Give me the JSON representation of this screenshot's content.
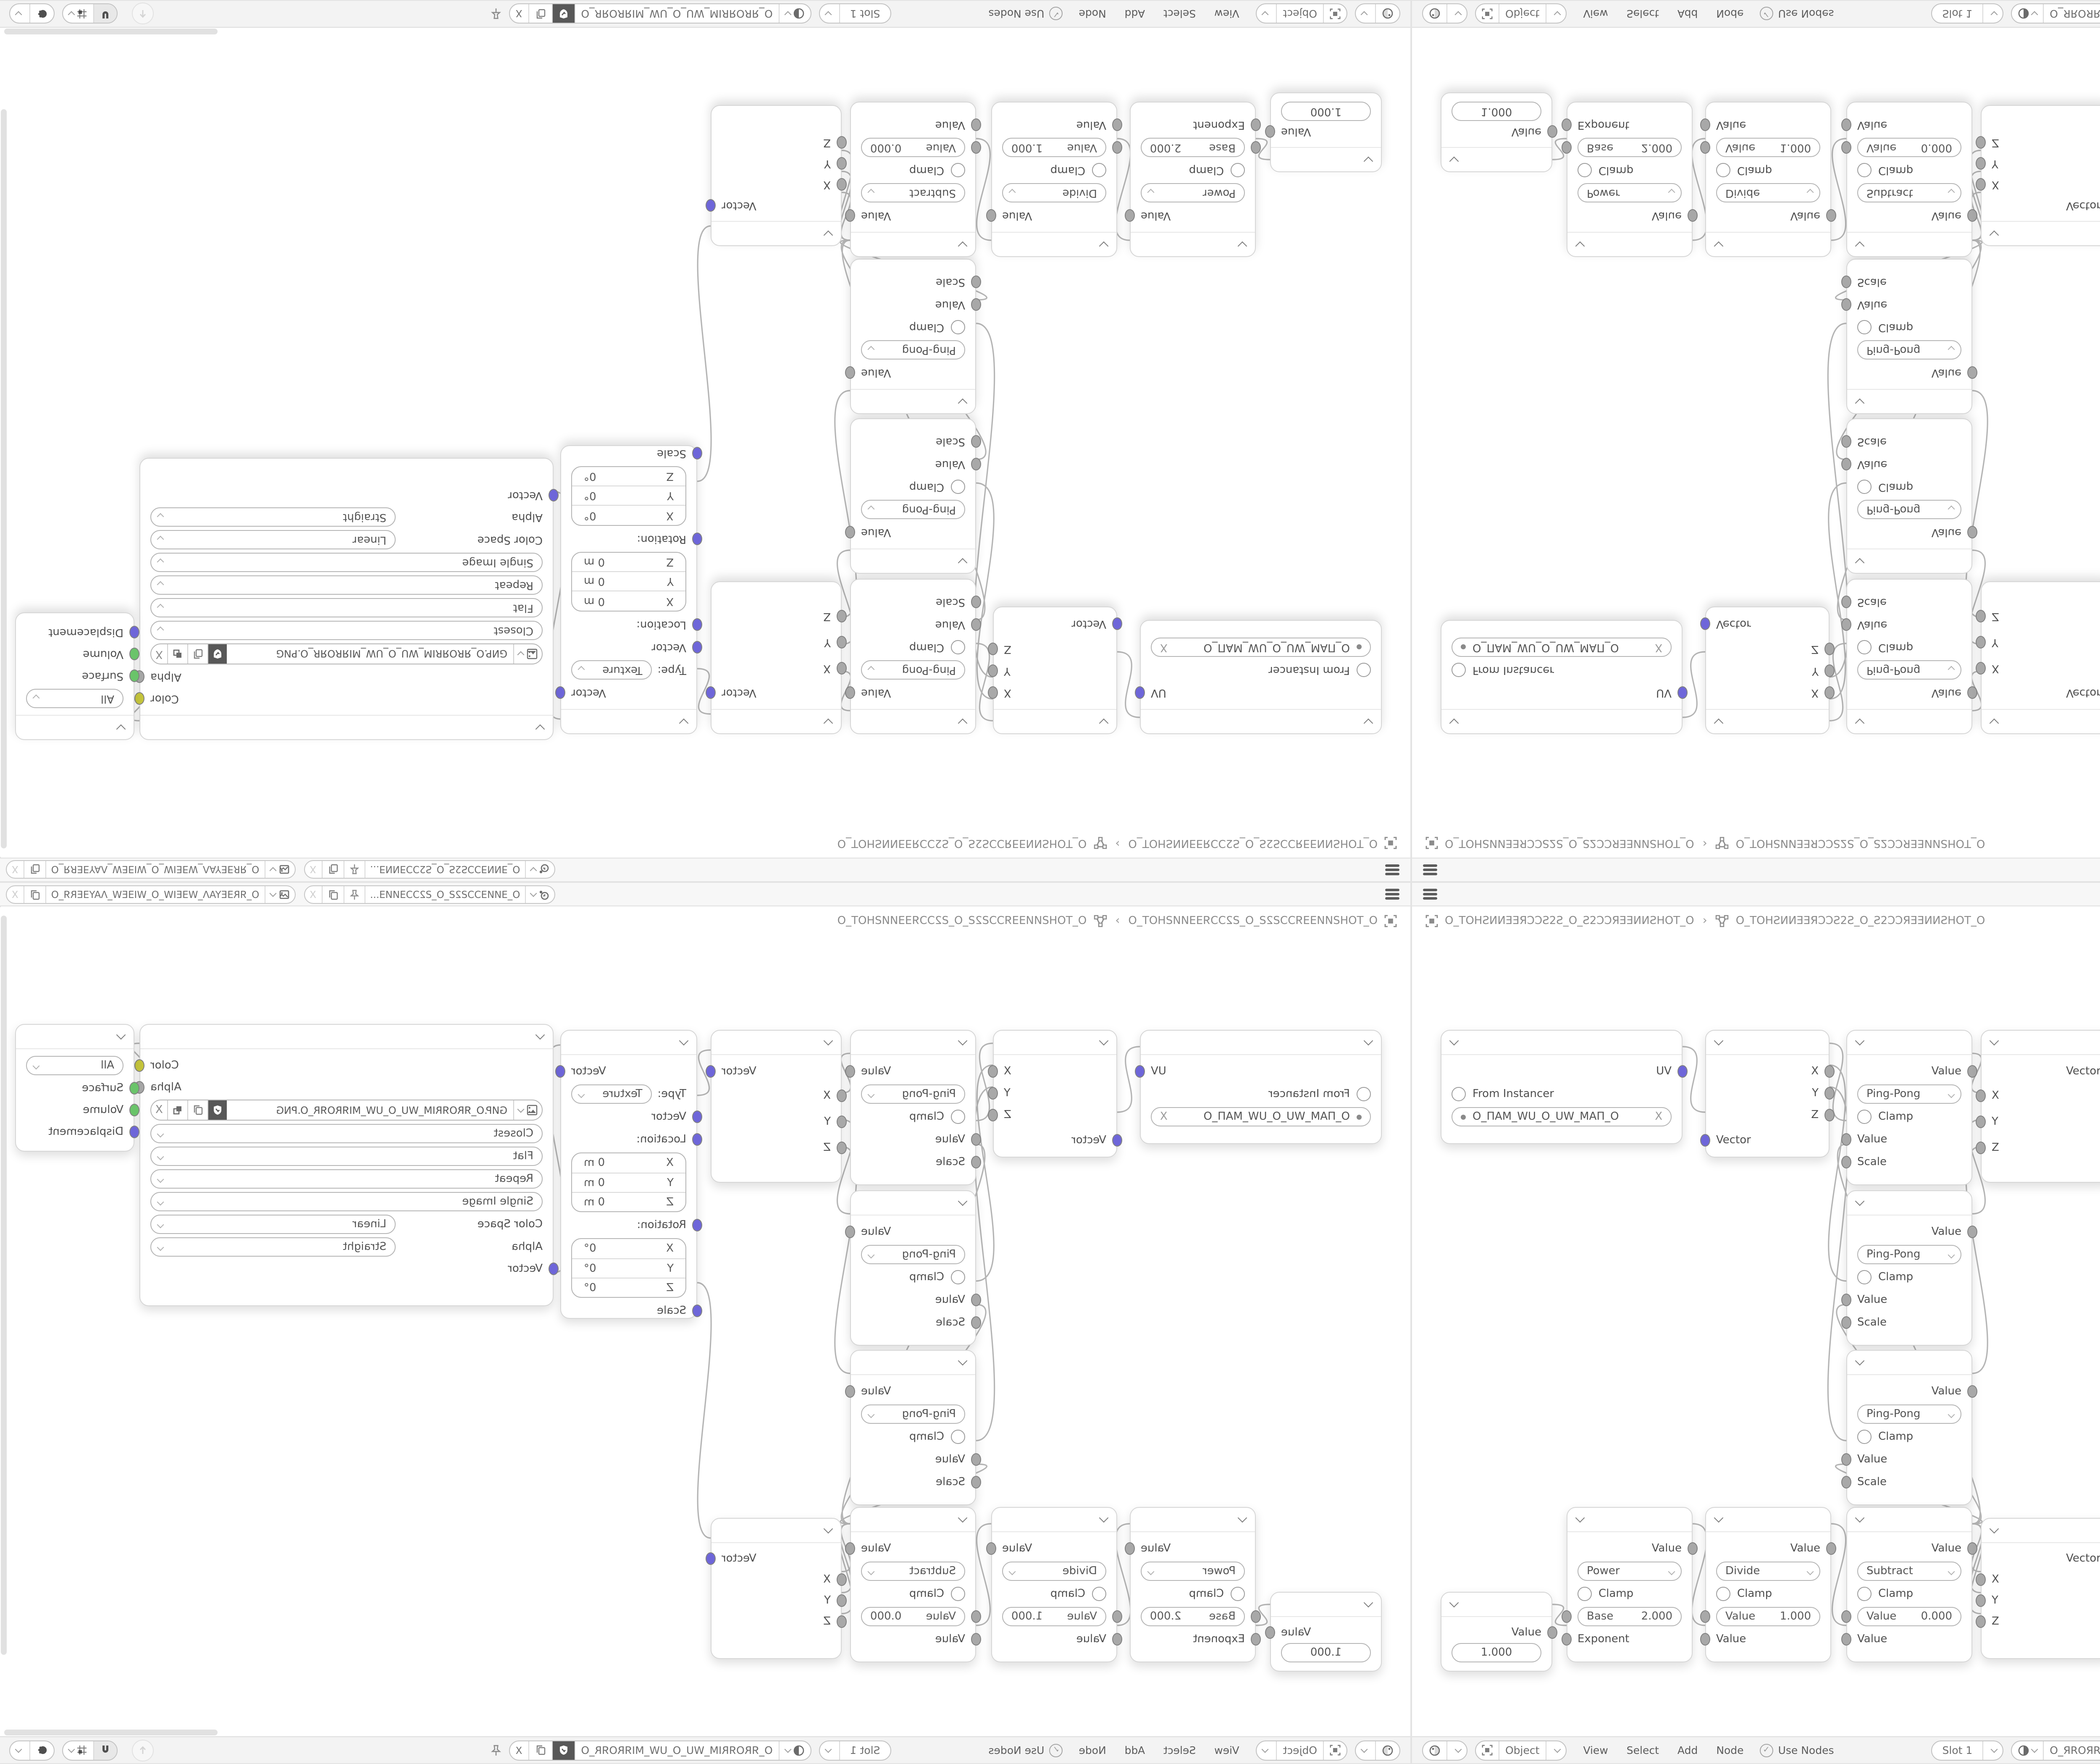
{
  "colors": {
    "vector": "#6e66d9",
    "value": "#a8a8a8",
    "color": "#c6c63c",
    "shader": "#6ac46a",
    "accent_text": "#4f4f4f",
    "wire": "#b5b5b5",
    "bar_bg": "#f3f3f3"
  },
  "top_bar": {
    "scene_name": "O_ƎИИƎƆƆƧ2Ƨ_O_Ƨ2ƆƆƎИИƎ...",
    "view_layer_name": "O_ЯRƎEYAΛ_WƎEIW_O_WIƎEW_ΛAYƎERЯ_O",
    "clear_label": "X"
  },
  "breadcrumb": {
    "object": "O_TOHƧИИƎƎЯƆƆƧ2Ƨ_O_Ƨ2ƆƆЯƎƎИИƧHOT_O",
    "separator": "›",
    "material": "O_TOHƧИИƎƎЯƆƆƧ2Ƨ_O_Ƨ2ƆƆЯƎƎИИƧHOT_O"
  },
  "nodes": {
    "uv": {
      "output": "UV",
      "from_instancer": "From Instancer",
      "uv_map": "O_ПAM_WU_O_UW_MAП_O",
      "clear": "X"
    },
    "sep": {
      "x": "X",
      "y": "Y",
      "z": "Z",
      "vector": "Vector"
    },
    "pingpong": {
      "output": "Value",
      "op": "Ping-Pong",
      "clamp": "Clamp",
      "value": "Value",
      "scale": "Scale"
    },
    "combine": {
      "output": "Vector",
      "x": "X",
      "y": "Y",
      "z": "Z"
    },
    "mapping": {
      "output": "Vector",
      "type_label": "Type:",
      "type": "Texture",
      "vector": "Vector",
      "location": "Location:",
      "rotation": "Rotation:",
      "scale": "Scale",
      "lx": "X",
      "lxv": "0 m",
      "ly": "Y",
      "lyv": "0 m",
      "lz": "Z",
      "lzv": "0 m",
      "rx": "X",
      "rxv": "0°",
      "ry": "Y",
      "ryv": "0°",
      "rz": "Z",
      "rzv": "0°"
    },
    "image_texture": {
      "color": "Color",
      "alpha": "Alpha",
      "file": "GИP.O_ЯROЯRIM_WU_O_UW_MIЯROЯR_O.PNG",
      "interpolation": "Closest",
      "projection": "Flat",
      "extension": "Repeat",
      "source": "Single Image",
      "color_space_label": "Color Space",
      "color_space": "Linear",
      "alpha_label": "Alpha",
      "alpha_mode": "Straight",
      "vector": "Vector",
      "clear": "X"
    },
    "output": {
      "target": "All",
      "surface": "Surface",
      "volume": "Volume",
      "displacement": "Displacement"
    },
    "value": {
      "output": "Value",
      "value": "1.000"
    },
    "power": {
      "output": "Value",
      "op": "Power",
      "clamp": "Clamp",
      "base_label": "Base",
      "base": "2.000",
      "exponent": "Exponent"
    },
    "divide": {
      "output": "Value",
      "op": "Divide",
      "clamp": "Clamp",
      "value_label": "Value",
      "value": "1.000",
      "value2": "Value"
    },
    "subtract": {
      "output": "Value",
      "op": "Subtract",
      "clamp": "Clamp",
      "value_label": "Value",
      "value": "0.000",
      "value2": "Value"
    }
  },
  "bottom_bar": {
    "shader_type": "Object",
    "menu_view": "View",
    "menu_select": "Select",
    "menu_add": "Add",
    "menu_node": "Node",
    "use_nodes": "Use Nodes",
    "check": "✓",
    "slot": "Slot 1",
    "material": "O_ЯROЯRIM_WU_O_UW_MIЯROЯR_O",
    "clear_label": "X"
  }
}
